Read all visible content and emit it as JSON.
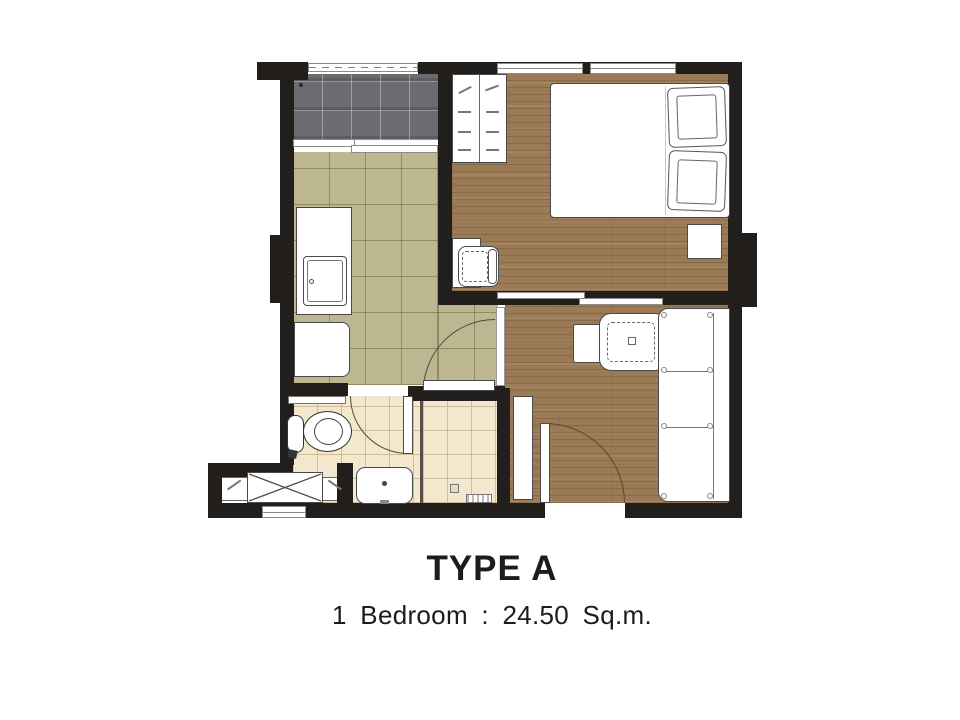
{
  "plan": {
    "title": "TYPE A",
    "subtitle": "1 Bedroom : 24.50 Sq.m.",
    "unit_type": "A",
    "bedrooms": 1,
    "area_sqm": 24.5,
    "rooms": [
      "balcony",
      "kitchen-hall",
      "bedroom",
      "living-room",
      "bathroom",
      "shower",
      "ac-ledge"
    ],
    "fixtures": [
      "sliding-window",
      "kitchen-counter",
      "sink",
      "base-cabinet",
      "wardrobe",
      "double-bed",
      "pillows",
      "bedside-table",
      "desk",
      "desk-chair",
      "lounge-chair",
      "ottoman",
      "sofa",
      "entry-door",
      "bathroom-door",
      "hall-door",
      "toilet",
      "washbasin",
      "shower-grate",
      "shoe-cabinet",
      "ac-condenser-unit",
      "louver-vent",
      "balcony-railing",
      "windows",
      "sliding-partition"
    ],
    "colors": {
      "wall": "#221e1b",
      "wood_floor": "#9b7b55",
      "kitchen_tile": "#bdb791",
      "balcony_tile": "#6b6b71",
      "bath_tile": "#f3e7ce",
      "furniture": "#ffffff",
      "outline": "#4a4a4a",
      "text": "#1c1c1c"
    }
  }
}
